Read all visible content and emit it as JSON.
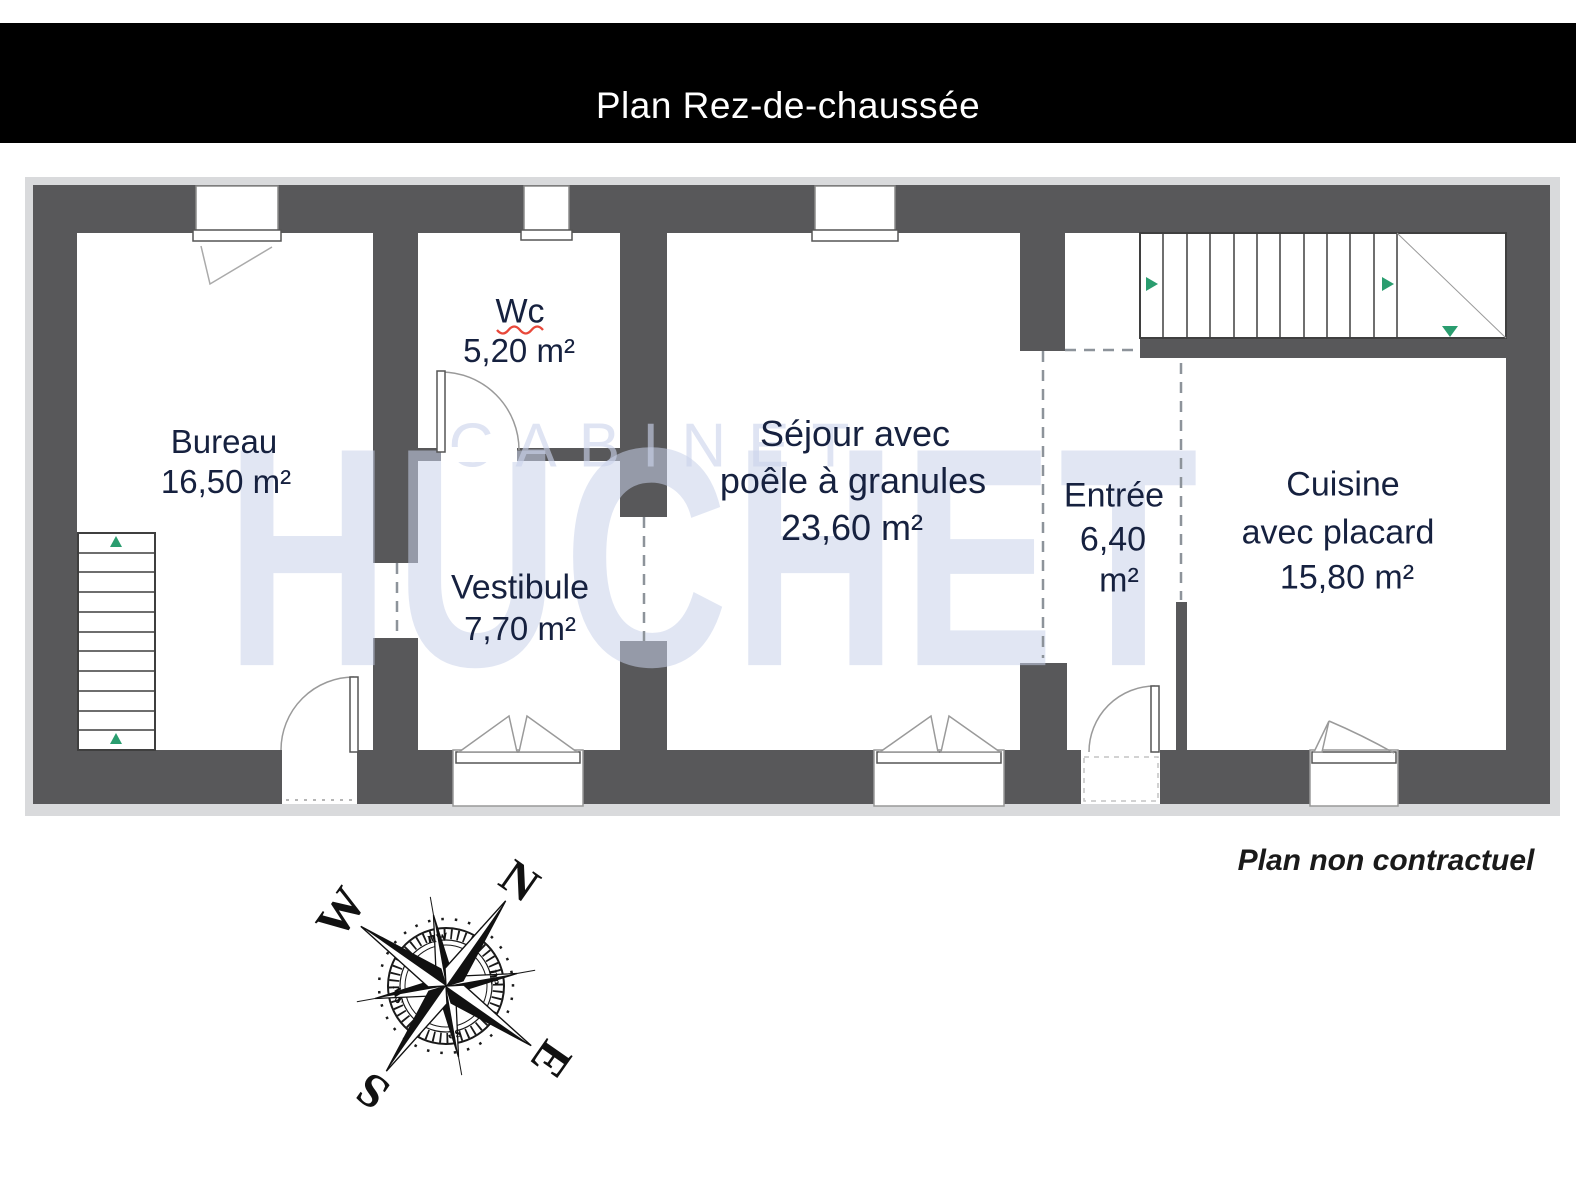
{
  "header": {
    "title": "Plan Rez-de-chaussée"
  },
  "rooms": {
    "bureau": {
      "name": "Bureau",
      "area": "16,50 m²"
    },
    "wc": {
      "name": "Wc",
      "area": "5,20 m²"
    },
    "vestibule": {
      "name": "Vestibule",
      "area": "7,70 m²"
    },
    "sejour": {
      "name_line1": "Séjour avec",
      "name_line2": "poêle à granules",
      "area": "23,60 m²"
    },
    "entree": {
      "name": "Entrée",
      "area_value": "6,40",
      "area_unit": "m²"
    },
    "cuisine": {
      "name_line1": "Cuisine",
      "name_line2": "avec placard",
      "area": "15,80 m²"
    }
  },
  "watermark": {
    "line1": "CABINET",
    "line2": "HUCHET"
  },
  "footer": {
    "note": "Plan non contractuel"
  },
  "compass": {
    "n": "N",
    "e": "E",
    "s": "S",
    "w": "W",
    "nw": "nw",
    "ne": "ne",
    "se": "se",
    "sw": "sw"
  },
  "colors": {
    "wall": "#58585a",
    "frame_shadow": "#d9dadc",
    "label_text": "#16213f",
    "header_bg": "#000000",
    "header_text": "#ffffff",
    "stair_arrow_green": "#2a9d6f",
    "wc_underline_red": "#e8483a",
    "watermark_blue": "#dfe4f1"
  }
}
